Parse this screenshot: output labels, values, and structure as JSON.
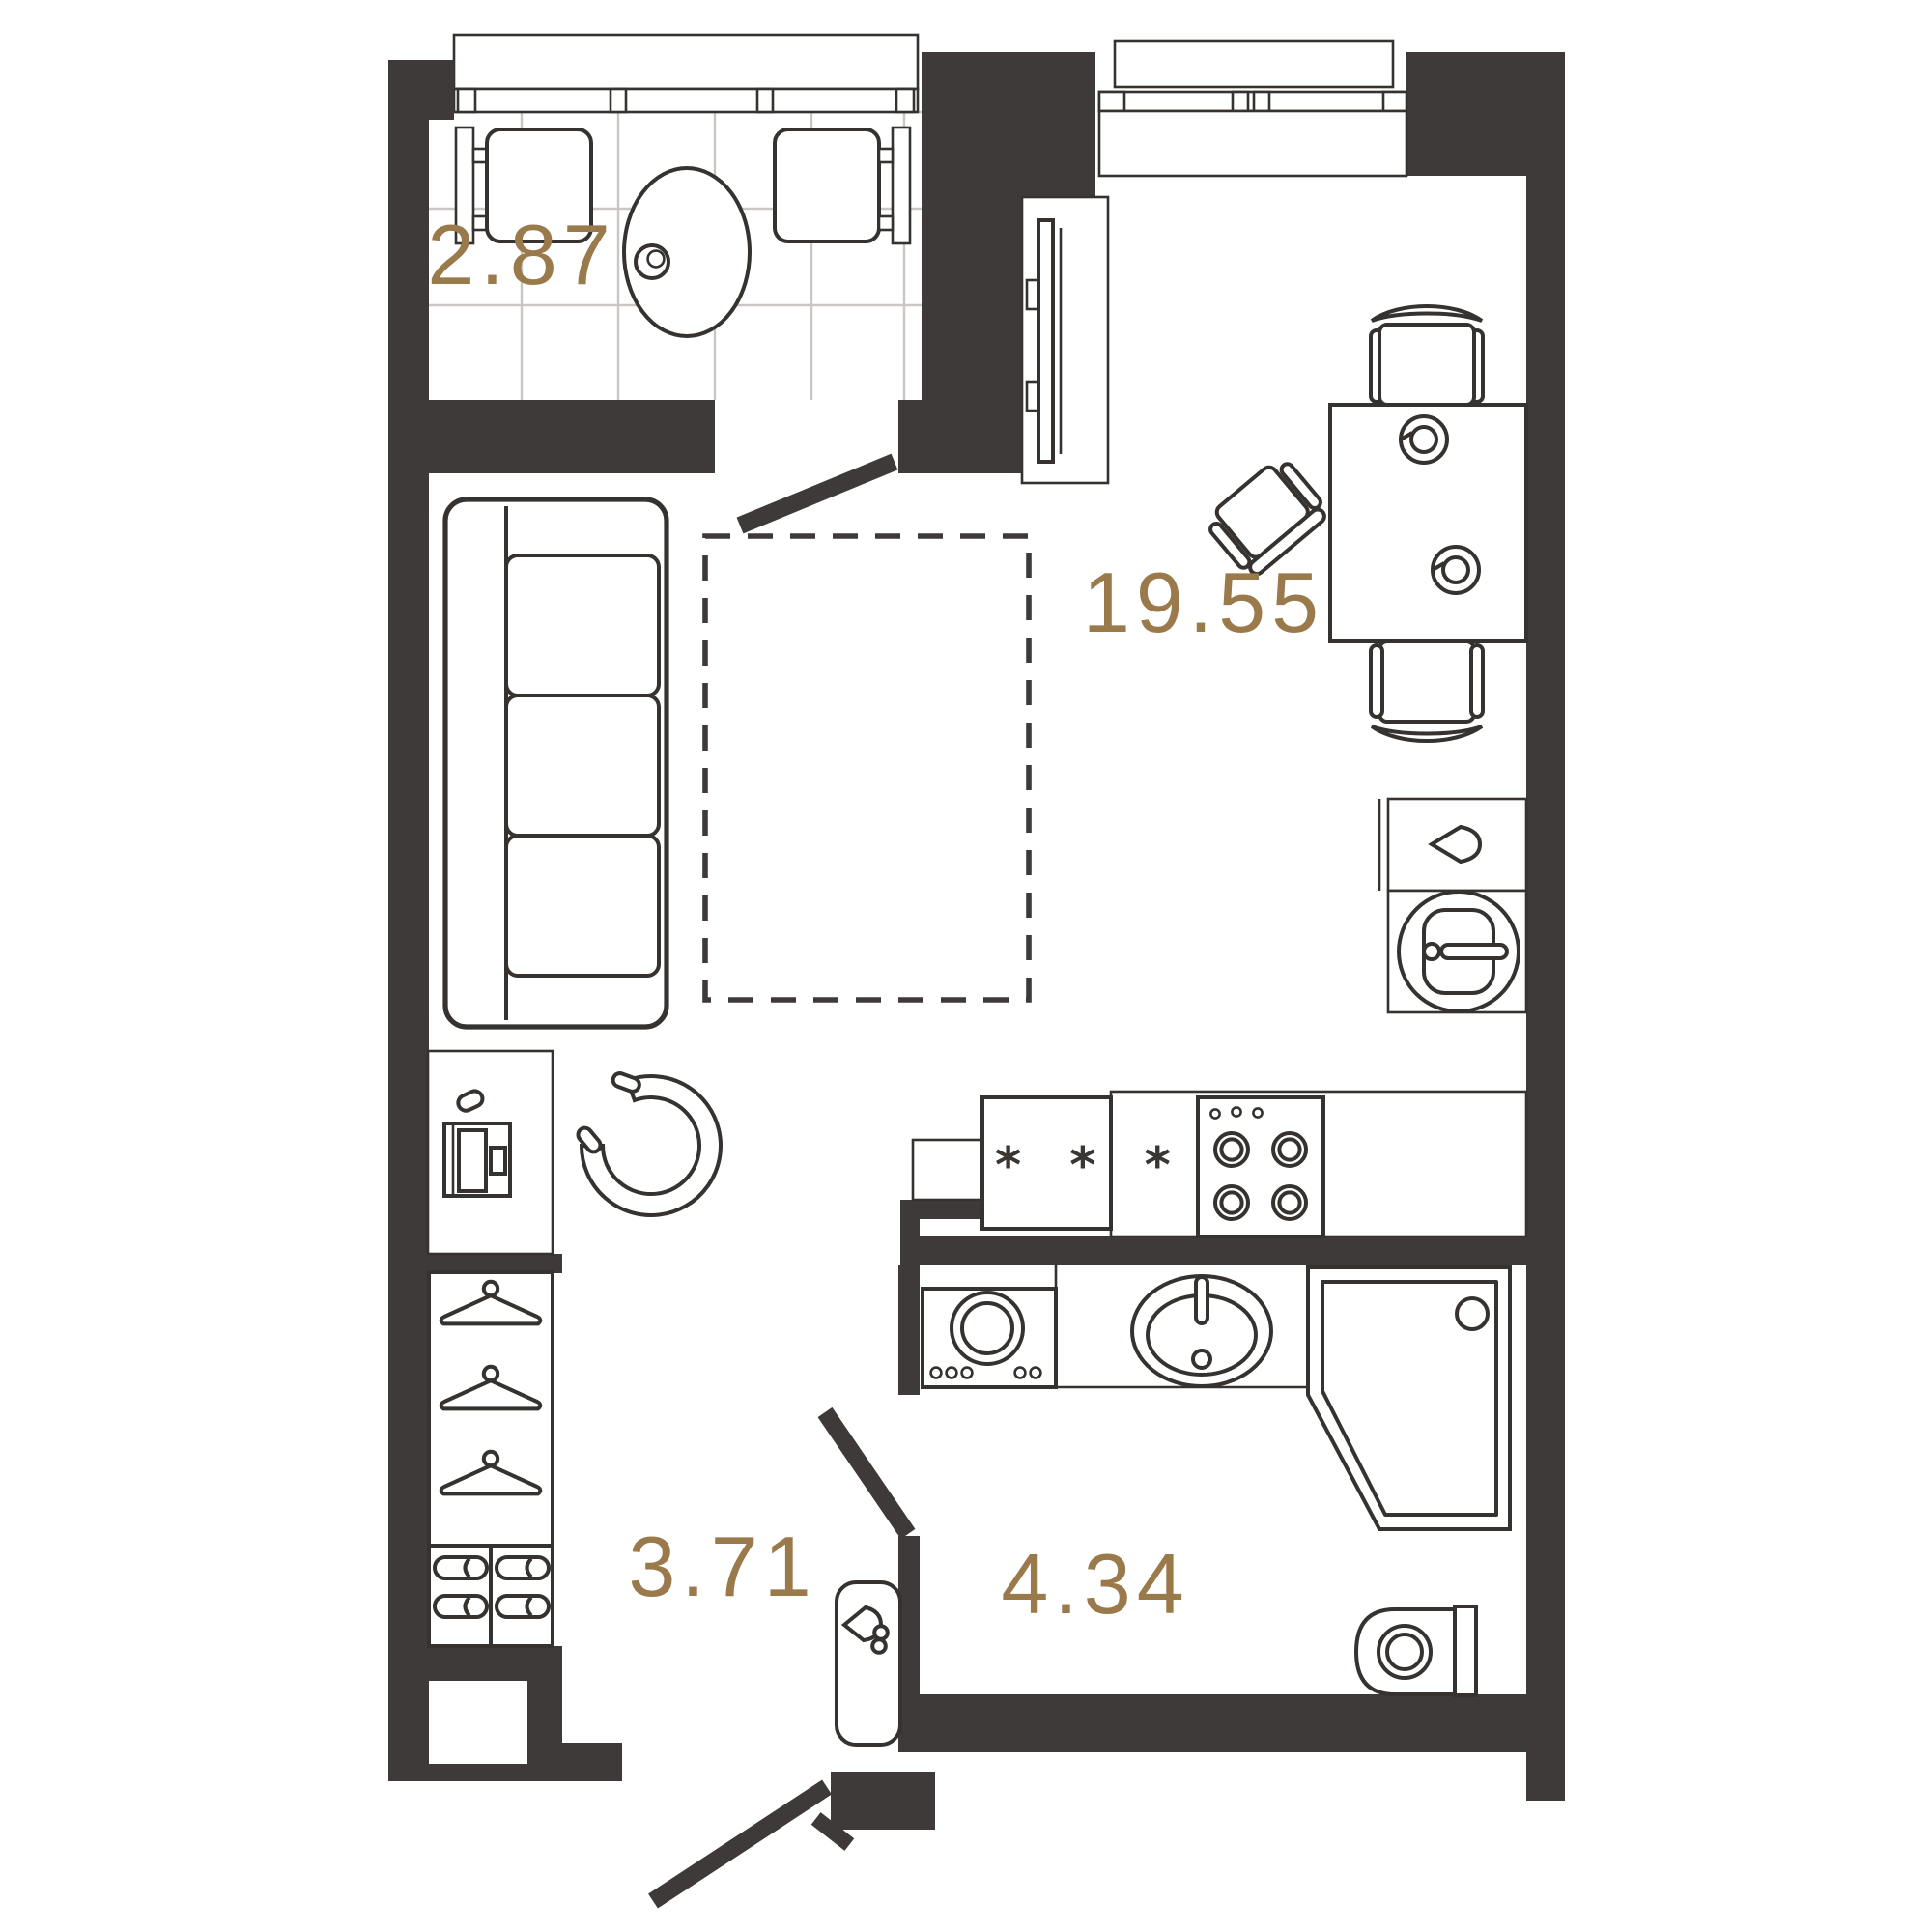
{
  "plan": {
    "title": "studio-apartment-floor-plan",
    "rooms": [
      {
        "name": "balcony",
        "area_label": "2.87"
      },
      {
        "name": "living-room",
        "area_label": "19.55"
      },
      {
        "name": "hallway",
        "area_label": "3.71"
      },
      {
        "name": "bathroom",
        "area_label": "4.34"
      }
    ],
    "kitchen": {
      "fridge_marking": "* * *"
    },
    "colors": {
      "wall": "#3E3A39",
      "furniture_line": "#35322F",
      "area_label": "#9A7A4B",
      "tile_grid": "#C9C6C3",
      "background": "#FFFFFF"
    },
    "icons": [
      "sofa",
      "bed-dashed",
      "armchair",
      "tv",
      "tv-stand",
      "wardrobe",
      "hanger-icon",
      "slipper-icon",
      "dining-table",
      "dining-chair",
      "desk-chair",
      "balcony-table",
      "balcony-chair",
      "cup-icon",
      "kitchen-sink",
      "kettle-icon",
      "fridge",
      "stove",
      "washing-machine",
      "bathroom-sink",
      "shower",
      "toilet",
      "water-heater",
      "door-leaf",
      "window"
    ]
  }
}
